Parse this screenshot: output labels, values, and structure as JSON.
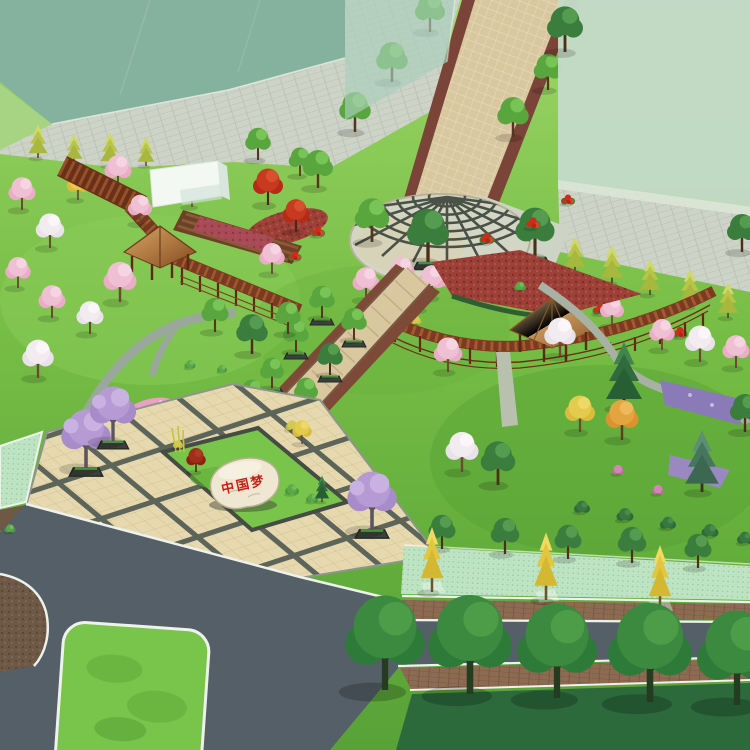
{
  "scene": {
    "stone": {
      "inscription": "中国梦"
    },
    "palette": {
      "ghost_left": "#84b1a0",
      "ghost_tower": "#a9cfbb",
      "ghost_right": "#c3dac7",
      "paving": "#cdd3c7",
      "lawn": "#76bd45",
      "lawn_dark": "#2c6a3c",
      "walkway": "#d9c7a0",
      "walkway_border": "#7a4438",
      "circle_pavement": "#d3d6c4",
      "circle_grid": "#4a5248",
      "plaza_tile": "#e6d9b0",
      "plaza_grid": "#4e574f",
      "road": "#545f68",
      "curb_white": "#eef2ec",
      "brick": "#8d6b52",
      "mesh": "#c2e4c6",
      "island_grass": "#79c44a",
      "mulch_brown": "#6e5846",
      "mulch_red": "#9c4038",
      "wood": "#7b3a22",
      "roof": "#c89a5e",
      "stone_fill": "#efe7d2",
      "stone_text": "#c32017"
    },
    "features": [
      "ghost-buildings",
      "pedestrian-walkway",
      "fan-paved-circular-plaza",
      "curved-wooden-pergola-left",
      "curved-wooden-pergola-right",
      "wooden-pavilions",
      "china-dream-stone",
      "feature-planting-island",
      "tile-grid-plaza",
      "jacaranda-trees",
      "cherry-blossom-trees",
      "ginkgo-street-trees",
      "traffic-island",
      "asphalt-road-junction",
      "grass-paver-strips",
      "flower-beds",
      "conifer-rows",
      "street-tree-rows"
    ]
  }
}
